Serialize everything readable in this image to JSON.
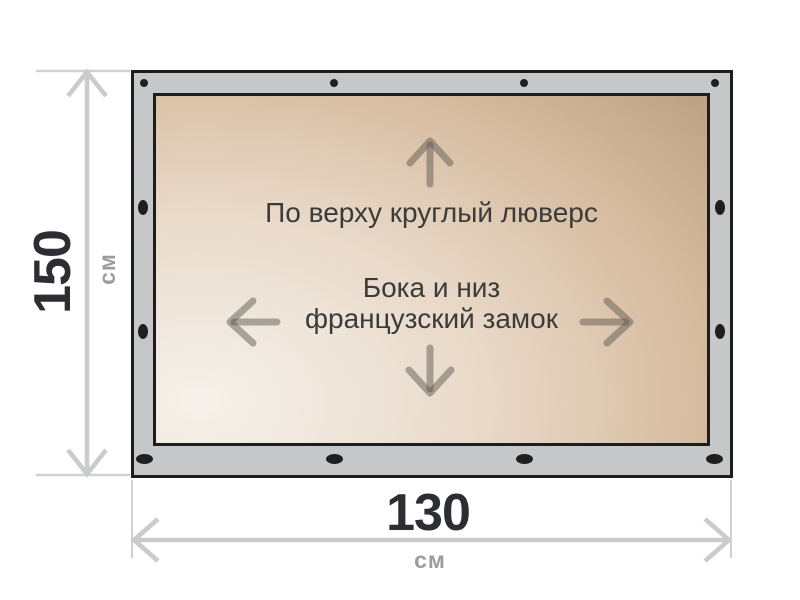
{
  "diagram": {
    "type": "product-dimension-diagram",
    "surface_labels": {
      "top": "По верху круглый люверс",
      "middle_line1": "Бока и низ",
      "middle_line2": "французский замок"
    },
    "dimensions": {
      "height": {
        "value": "150",
        "unit": "см"
      },
      "width": {
        "value": "130",
        "unit": "см"
      }
    },
    "icons": {
      "up": "up-arrow-icon",
      "down": "down-arrow-icon",
      "left": "left-arrow-icon",
      "right": "right-arrow-icon",
      "height_dim": "vertical-dimension-arrow",
      "width_dim": "horizontal-dimension-arrow"
    },
    "colors": {
      "background": "#ffffff",
      "frame_fill": "#c6c7c9",
      "frame_border": "#1d1d1d",
      "surface_light": "#f6f1ea",
      "surface_dark": "#b89d81",
      "grommet": "#1f1f1f",
      "direction_arrow": "rgba(90,85,78,0.48)",
      "dimension_line": "#c9cbcd",
      "number_text": "#2c2e33",
      "unit_text": "#9c9c9c",
      "label_text": "#3b3b3b"
    }
  }
}
